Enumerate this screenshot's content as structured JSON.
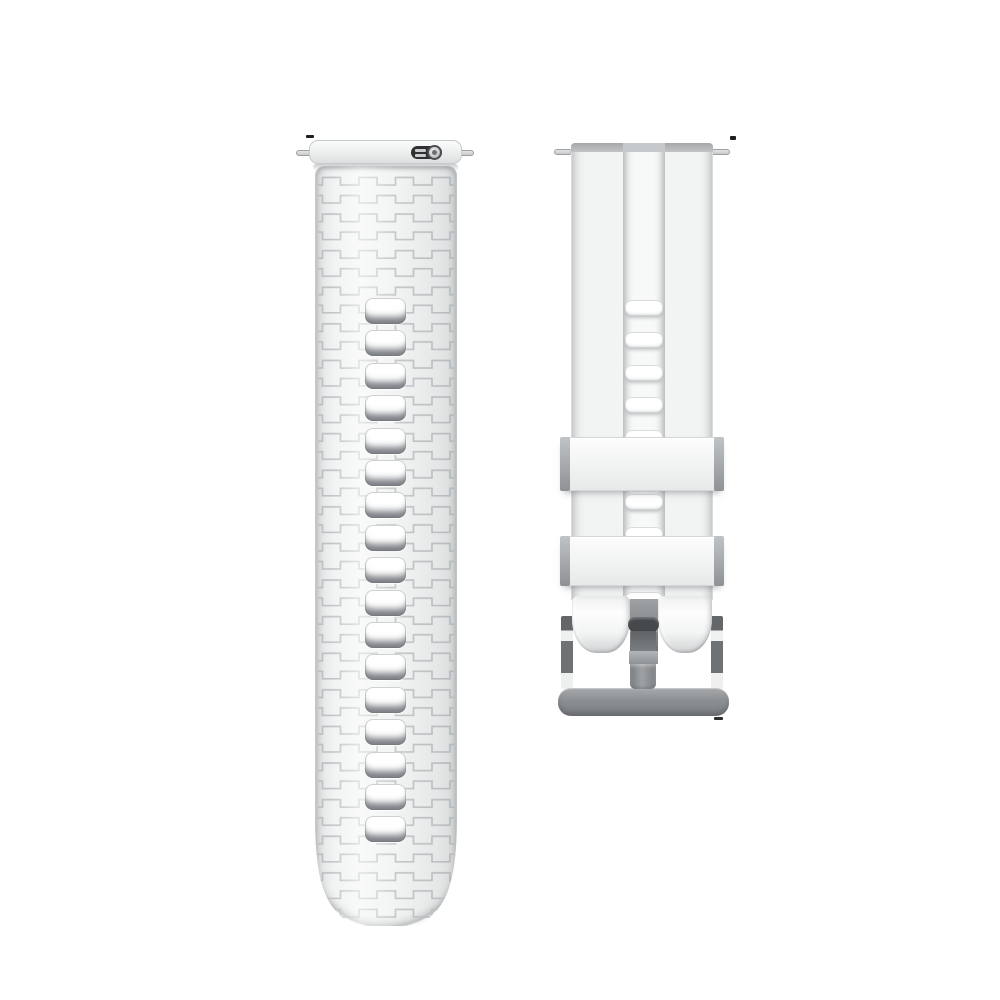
{
  "scene": {
    "subject": "white silicone watch strap set, two halves",
    "background_color": "#ffffff"
  },
  "colors": {
    "strap_base": "#f2f3f3",
    "strap_edge": "#d2d4d5",
    "pattern_line": "#c4c7c9",
    "band_top": "#a5a8aa",
    "keeper_cap": "#8f9294",
    "buckle_metal": "#8d9093",
    "buckle_dark": "#45494c",
    "lever_dark": "#2e3133",
    "pin_metal": "#c6c8ca"
  },
  "left_strap": {
    "kind": "textured strap half with quick-release spring bar",
    "holes": {
      "count": 17,
      "pitch": 32.4,
      "first_top": 132,
      "left": 50,
      "width": 41,
      "height": 26
    }
  },
  "right_strap": {
    "kind": "buckle strap half with center channel and two keeper loops",
    "keepers_count": 2,
    "holes": {
      "count": 10,
      "pitch": 32.4,
      "first_top": 157,
      "left": 2,
      "width": 38,
      "height": 16
    }
  },
  "buckle": {
    "kind": "silver pin buckle with tongue"
  }
}
